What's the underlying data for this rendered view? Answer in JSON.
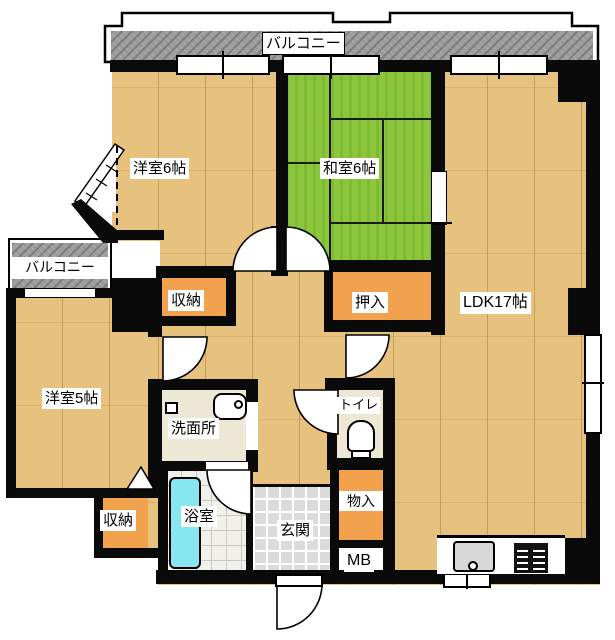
{
  "floorplan": {
    "labels": {
      "balcony_top": "バルコニー",
      "balcony_left": "バルコニー",
      "western_room_6": "洋室6帖",
      "japanese_room_6": "和室6帖",
      "ldk": "LDK17帖",
      "closet_upper": "収納",
      "oshiire": "押入",
      "western_room_5": "洋室5帖",
      "washroom": "洗面所",
      "toilet": "トイレ",
      "bathroom": "浴室",
      "entrance": "玄関",
      "closet_lower": "収納",
      "storage_small": "物入",
      "meter_box": "MB"
    },
    "colors": {
      "wood": "#E7C27E",
      "tatami": "#8CC63B",
      "closet_orange": "#F2A24D",
      "bathtub_cyan": "#86E7F0",
      "balcony_gray": "#9C9C9C",
      "tile_gray": "#DBDBDB",
      "service_cream": "#EDE8D5",
      "wall_black": "#0A0A0A"
    }
  }
}
